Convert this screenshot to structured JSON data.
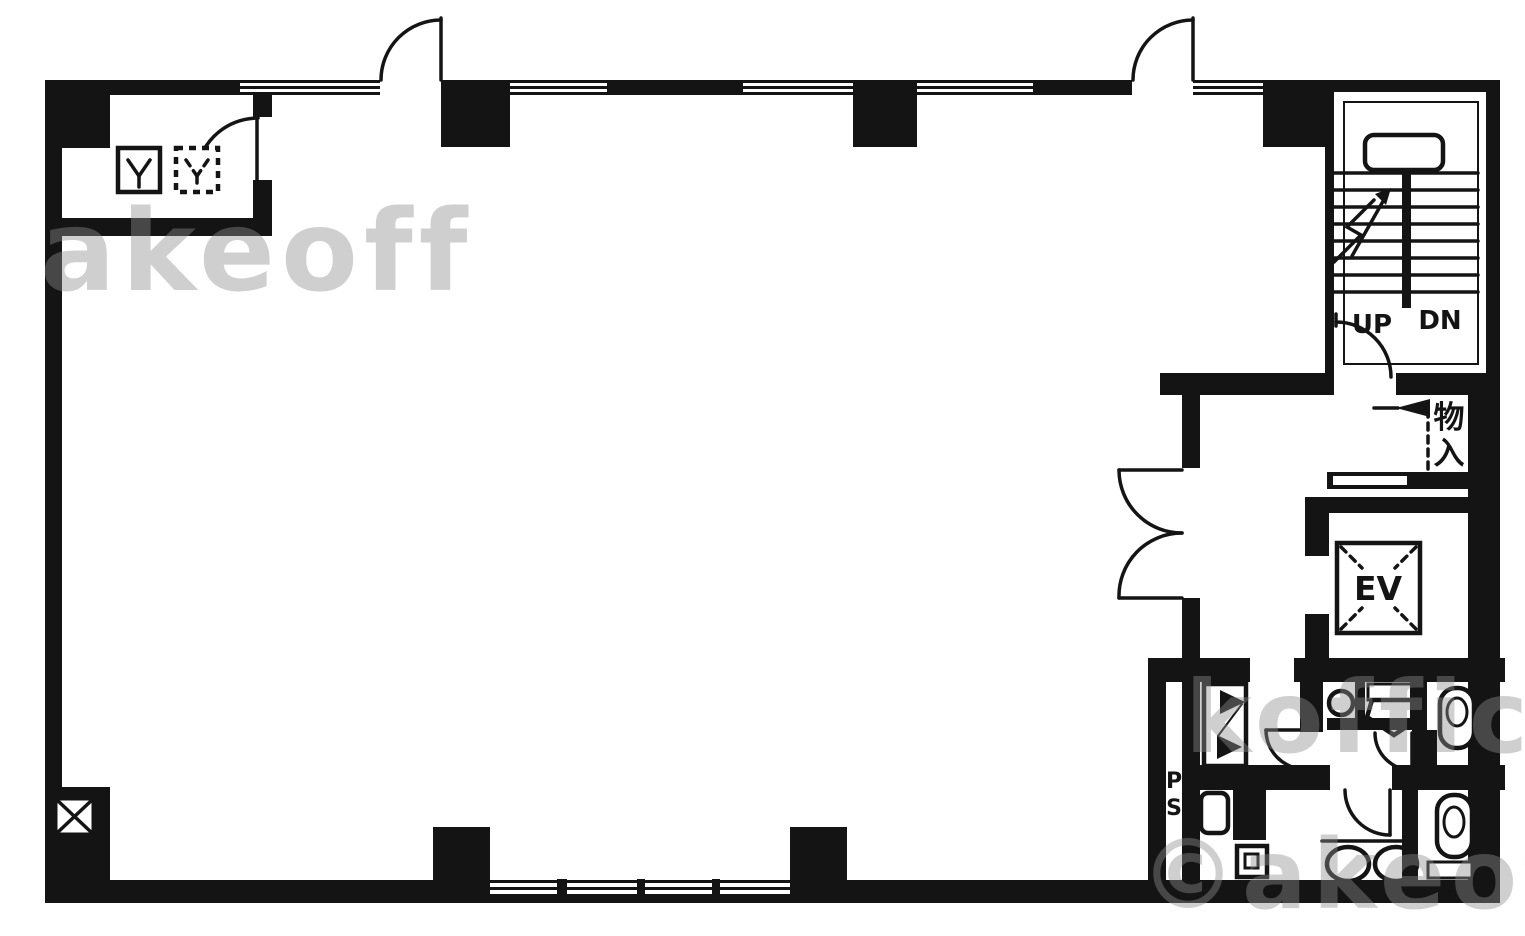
{
  "plan": {
    "stairwell": {
      "up_label": "UP",
      "down_label": "DN"
    },
    "elevator": {
      "label": "EV"
    },
    "storage": {
      "char_top": "物",
      "char_bottom": "入"
    },
    "pipe_shaft": {
      "char_top": "P",
      "char_bottom": "S"
    }
  },
  "watermarks": {
    "top_left": "akeoff",
    "middle_right": "koffice",
    "bottom_right": "©akeoffice"
  },
  "colors": {
    "ink": "#141414",
    "paper": "#ffffff",
    "watermark_gray": "#8f8f8f"
  }
}
